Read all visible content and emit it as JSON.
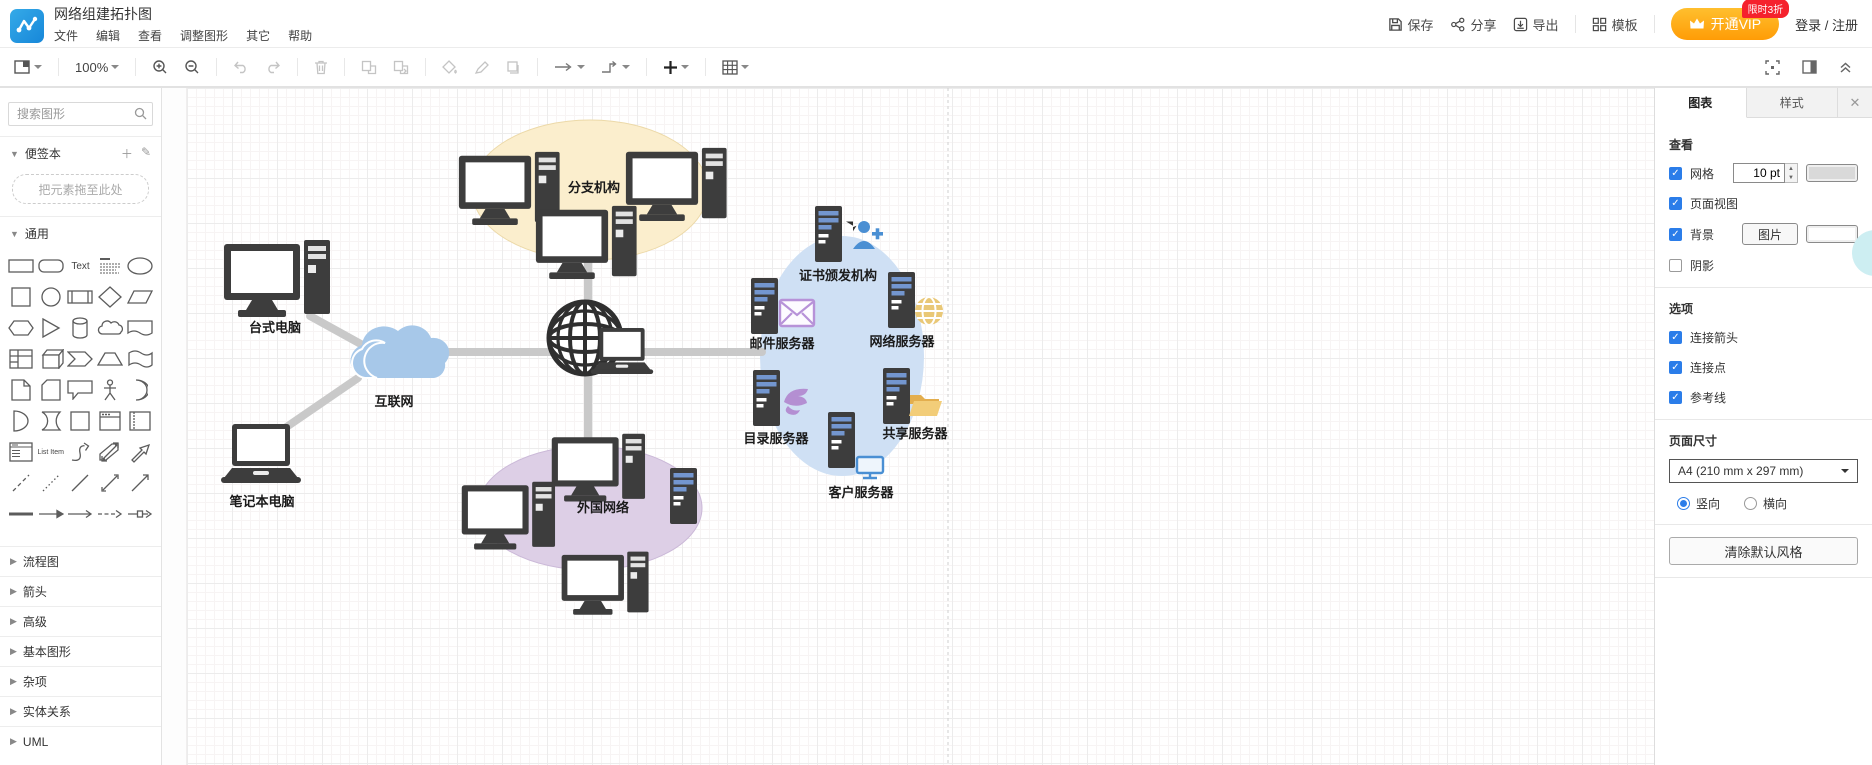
{
  "header": {
    "title": "网络组建拓扑图",
    "menu": [
      "文件",
      "编辑",
      "查看",
      "调整图形",
      "其它",
      "帮助"
    ],
    "actions": {
      "save": "保存",
      "share": "分享",
      "export": "导出",
      "template": "模板",
      "vip": "开通VIP",
      "vip_badge": "限时3折",
      "login": "登录 / 注册"
    }
  },
  "toolbar": {
    "zoom_level": "100%"
  },
  "sidebar": {
    "search_placeholder": "搜索图形",
    "scratchpad_title": "便签本",
    "drop_hint": "把元素拖至此处",
    "general_title": "通用",
    "text_shape_label": "Text",
    "list_item_label": "List Item",
    "sections": [
      "流程图",
      "箭头",
      "高级",
      "基本图形",
      "杂项",
      "实体关系",
      "UML"
    ]
  },
  "canvas": {
    "labels": {
      "branch": "分支机构",
      "desktop": "台式电脑",
      "internet": "互联网",
      "laptop": "笔记本电脑",
      "foreign": "外国网络",
      "ca": "证书颁发机构",
      "mail": "邮件服务器",
      "web": "网络服务器",
      "directory": "目录服务器",
      "share": "共享服务器",
      "client": "客户服务器"
    },
    "colors": {
      "branch_ellipse": "#fbeecd",
      "foreign_ellipse": "#ddcfe6",
      "dmz_blob": "#cfe0f4",
      "cloud": "#a7c8e9",
      "connector": "#c9c9c9",
      "device_dark": "#3d3d3d",
      "server_bar_blue": "#7396cf"
    }
  },
  "panel": {
    "tabs": [
      "图表",
      "样式"
    ],
    "view": {
      "heading": "查看",
      "grid": "网格",
      "grid_size": "10 pt",
      "page_view": "页面视图",
      "background": "背景",
      "image_button": "图片",
      "shadow": "阴影"
    },
    "options": {
      "heading": "选项",
      "items": [
        "连接箭头",
        "连接点",
        "参考线"
      ]
    },
    "page_size": {
      "heading": "页面尺寸",
      "value": "A4 (210 mm x 297 mm)",
      "portrait": "竖向",
      "landscape": "横向"
    },
    "clear_button": "清除默认风格"
  }
}
